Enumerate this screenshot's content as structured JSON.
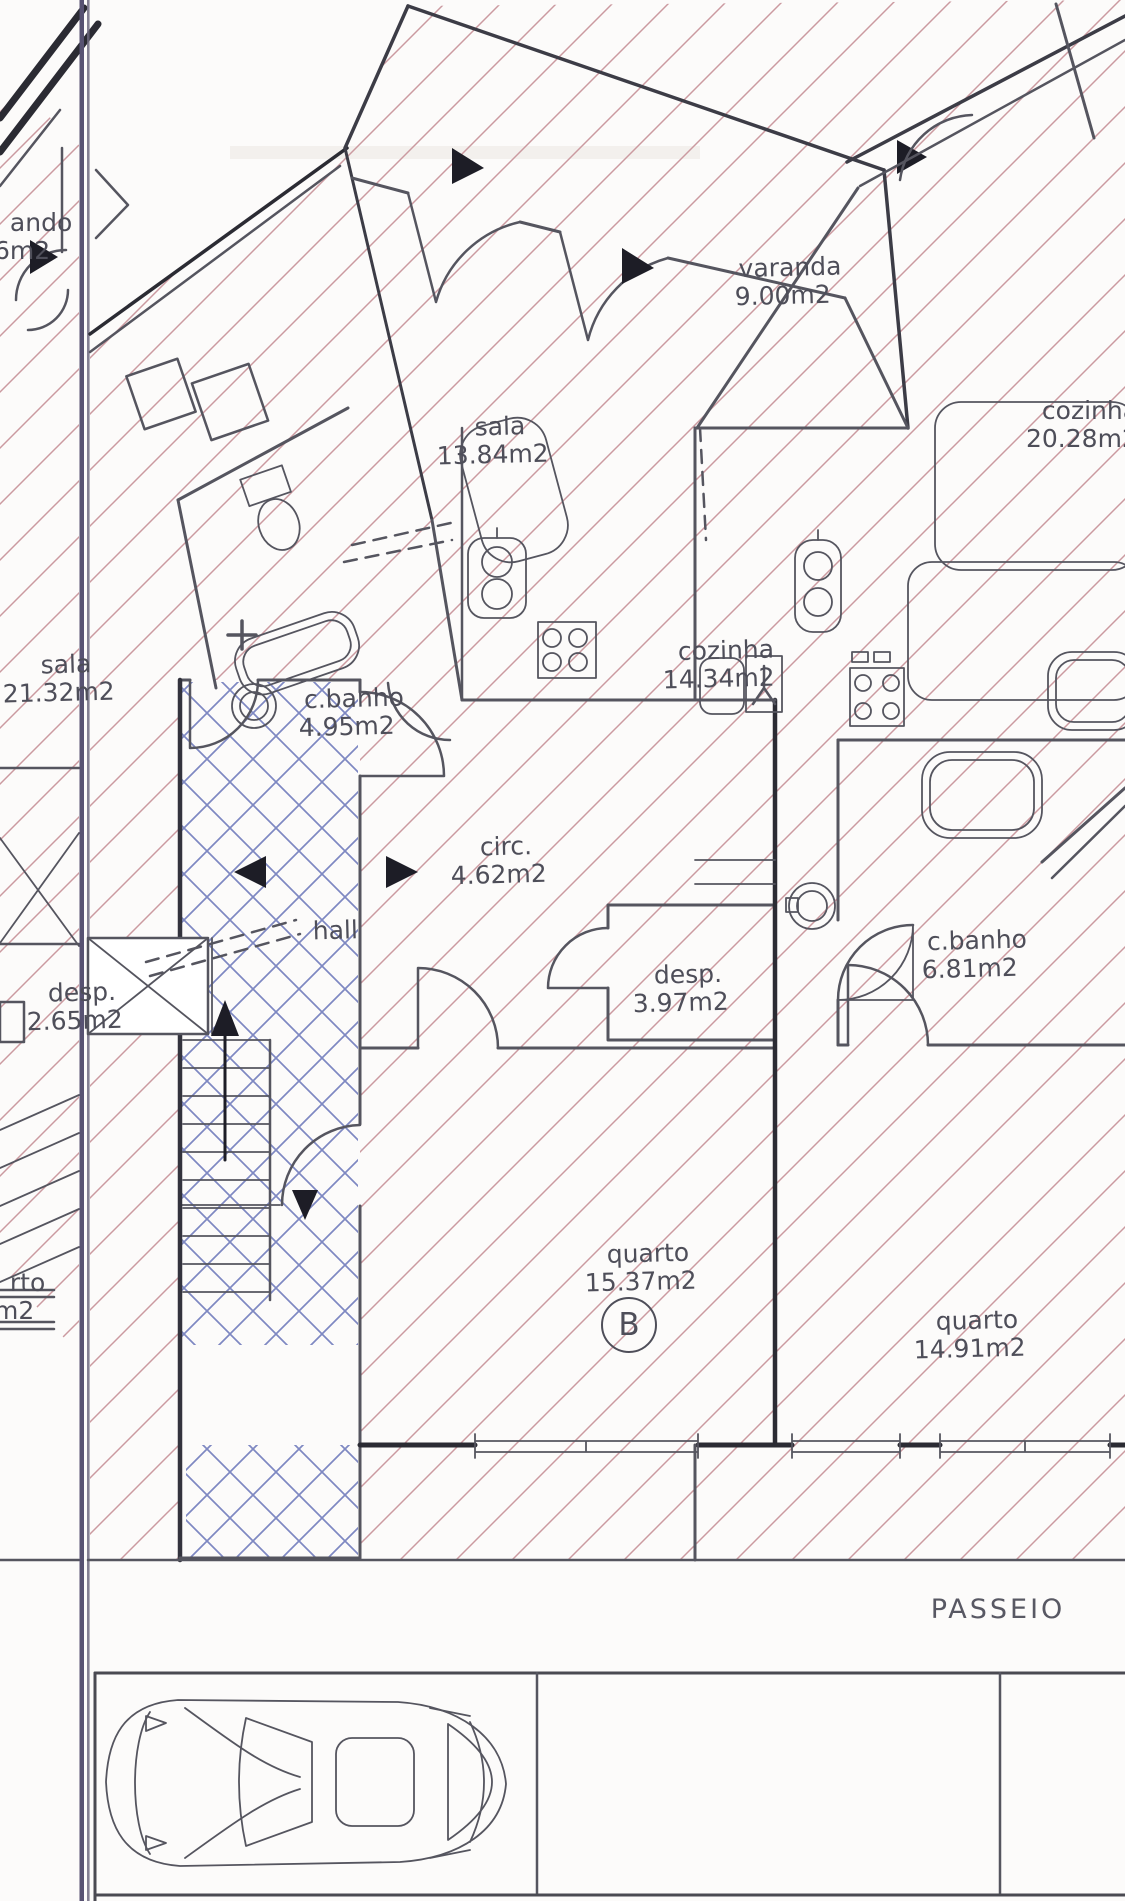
{
  "document": {
    "type": "scanned architectural floor plan",
    "unit_badge": "B"
  },
  "colors": {
    "paper": "#fcfbfa",
    "line": "#55555f",
    "wall_dark": "#33333d",
    "hatch_pink": "#cb9aa0",
    "hatch_blue": "#7e88c2",
    "text": "#4e4e59",
    "page_fold": "#575272"
  },
  "rooms": {
    "varanda_b": {
      "name": "varanda",
      "area": "9.00m2"
    },
    "sala_b": {
      "name": "sala",
      "area": "13.84m2"
    },
    "cozinha_b": {
      "name": "cozinha",
      "area": "14.34m2"
    },
    "cbanho_b": {
      "name": "c.banho",
      "area": "4.95m2"
    },
    "circ_b": {
      "name": "circ.",
      "area": "4.62m2"
    },
    "hall_b": {
      "name": "hall"
    },
    "desp_b": {
      "name": "desp.",
      "area": "3.97m2"
    },
    "quarto_b": {
      "name": "quarto",
      "area": "15.37m2"
    },
    "cozinha_right": {
      "name": "cozinha",
      "area": "20.28m2"
    },
    "cbanho_right": {
      "name": "c.banho",
      "area": "6.81m2"
    },
    "quarto_right": {
      "name": "quarto",
      "area": "14.91m2"
    },
    "sala_left": {
      "name": "sala",
      "area": "21.32m2"
    },
    "desp_left": {
      "name": "desp.",
      "area": "2.65m2"
    },
    "quarto_left_fragment": {
      "name": "rto",
      "area": "m2"
    },
    "varanda_left_fragment": {
      "name": "ando",
      "area": "6m2"
    }
  },
  "street": {
    "passeio_label": "PASSEIO"
  }
}
